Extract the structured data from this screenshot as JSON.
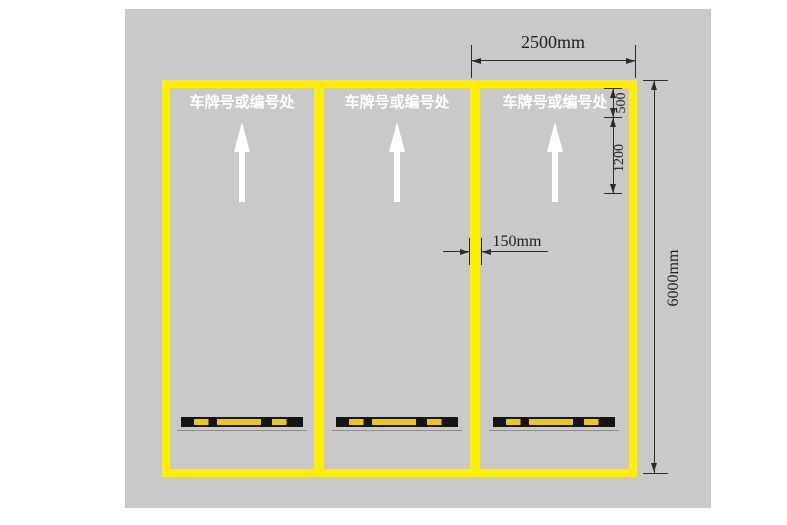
{
  "diagram": {
    "title": "parking-space-marking-plan",
    "colors": {
      "pavement_gray": "#c9c9c9",
      "marking_yellow": "#ffee00",
      "dimension_line": "#2b2b2b",
      "label_white": "#ffffff",
      "wheel_stop_black": "#151515",
      "wheel_stop_yellow": "#efc713"
    },
    "spaces": [
      {
        "label": "车牌号或编号处",
        "direction_arrow": "up",
        "wheel_stop": true
      },
      {
        "label": "车牌号或编号处",
        "direction_arrow": "up",
        "wheel_stop": true
      },
      {
        "label": "车牌号或编号处",
        "direction_arrow": "up",
        "wheel_stop": true
      }
    ],
    "dimensions": {
      "space_width": "2500mm",
      "label_offset": "500",
      "arrow_zone_length": "1200",
      "line_width": "150mm",
      "space_length": "6000mm"
    }
  }
}
